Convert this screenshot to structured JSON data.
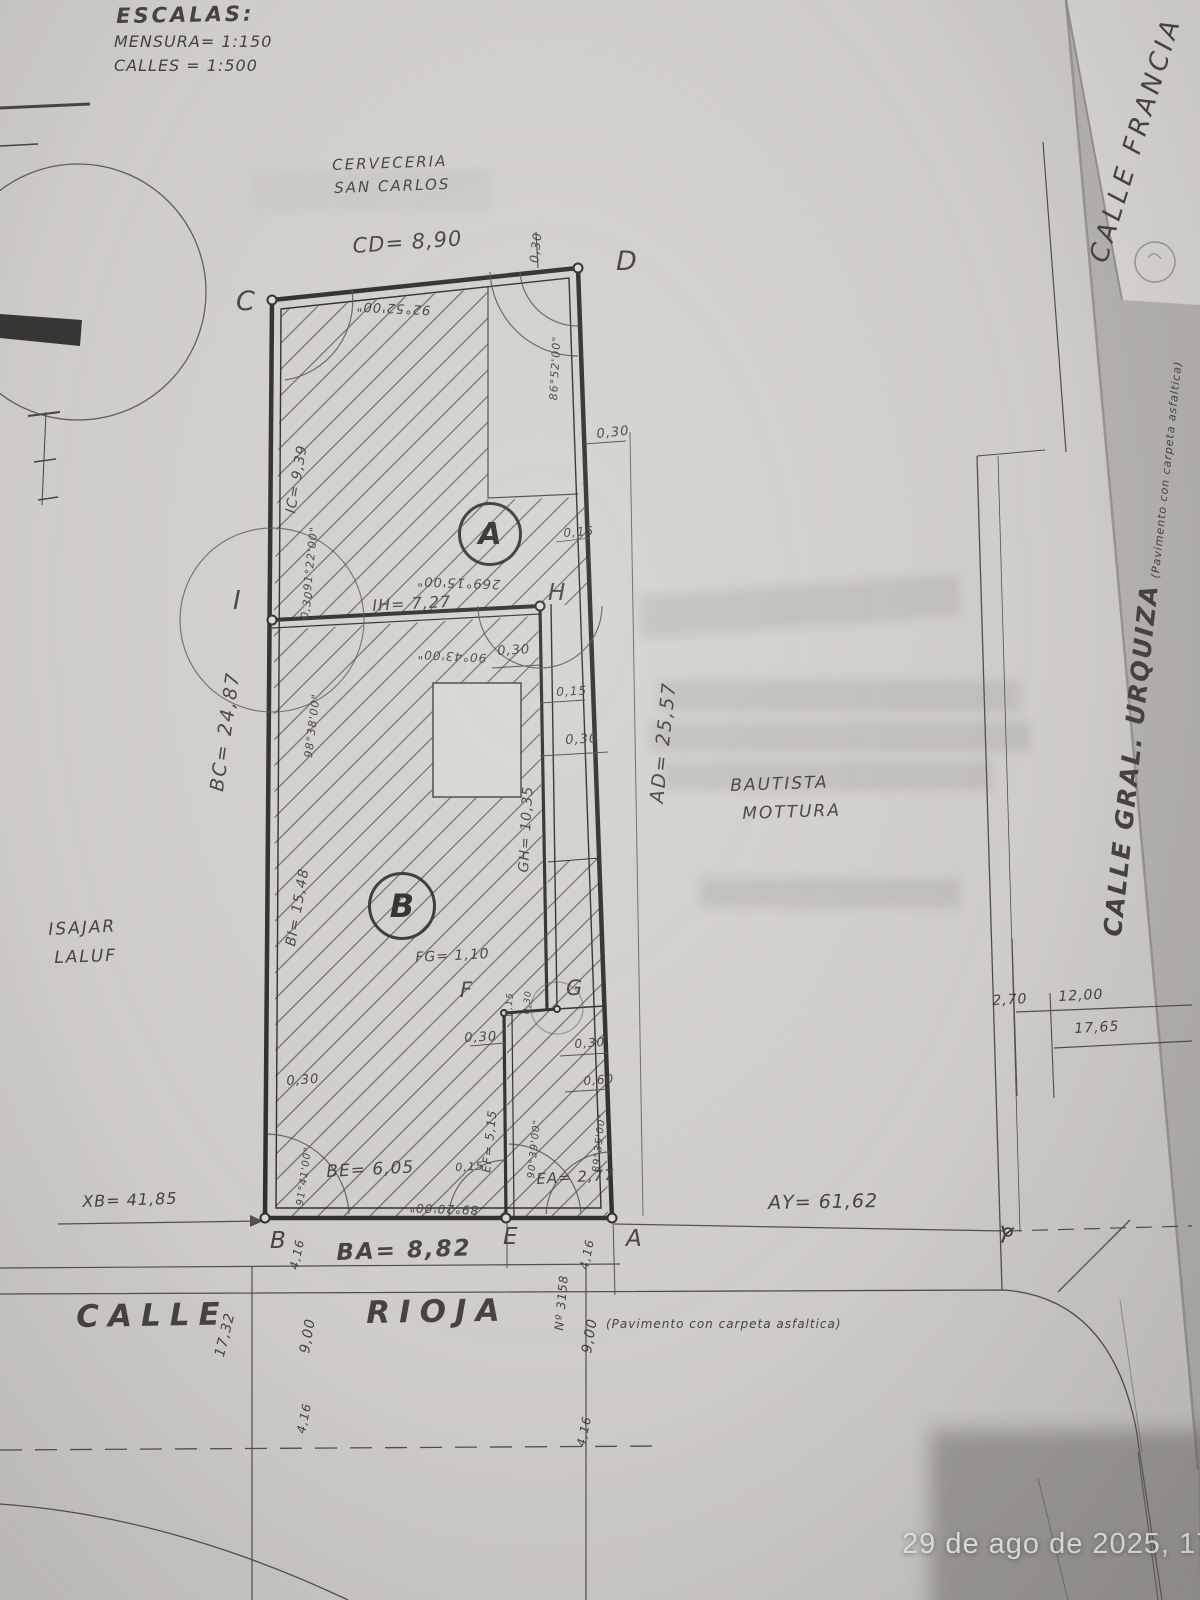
{
  "scales": {
    "title": "ESCALAS:",
    "mensura": "MENSURA= 1:150",
    "calles": "CALLES = 1:500"
  },
  "places": {
    "cerveceria1": "CERVECERIA",
    "cerveceria2": "SAN CARLOS",
    "francia": "CALLE FRANCIA",
    "urquiza": "CALLE GRAL. URQUIZA",
    "urquiza_note": "(Pavimento con carpeta asfaltica)",
    "mottura1": "BAUTISTA",
    "mottura2": "MOTTURA",
    "laluf1": "ISAJAR",
    "laluf2": "LALUF",
    "calle": "CALLE",
    "rioja": "RIOJA",
    "rioja_note": "(Pavimento con carpeta asfaltica)"
  },
  "points": {
    "a": "A",
    "b": "B",
    "c": "C",
    "d": "D",
    "e": "E",
    "f": "F",
    "g": "G",
    "h": "H",
    "i": "I",
    "y": "Y"
  },
  "parcels": {
    "a": "A",
    "b": "B"
  },
  "dims": {
    "cd": "CD= 8,90",
    "bc": "BC= 24,87",
    "ad": "AD= 25,57",
    "ic": "IC= 9,39",
    "ih": "IH= 7,27",
    "gh": "GH= 10,35",
    "fg": "FG= 1,10",
    "bi": "BI= 15,48",
    "be": "BE= 6,05",
    "ea": "EA= 2,77",
    "ba": "BA= 8,82",
    "ef": "EF= 5,15",
    "xb": "XB= 41,85",
    "ay": "AY= 61,62"
  },
  "angles": {
    "c": "92°52'00\"",
    "d": "86°52'00\"",
    "ic": "91°22'00\"",
    "i": "98°38'00\"",
    "a_int": "269°15'00\"",
    "h": "90°43'00\"",
    "b": "91°41'00\"",
    "e_left": "89°20'00\"",
    "e_right": "90°39'00\"",
    "a": "89°35'00\""
  },
  "offsets": {
    "v030": "0,30",
    "v015": "0,15",
    "v060": "0,60"
  },
  "street": {
    "n3158": "Nº 3158",
    "d416": "4,16",
    "d900": "9,00",
    "d1732": "17,32",
    "d270": "2,70",
    "d1200": "12,00",
    "d1765": "17,65"
  },
  "photo": {
    "timestamp": "29 de ago de 2025, 17:17"
  }
}
